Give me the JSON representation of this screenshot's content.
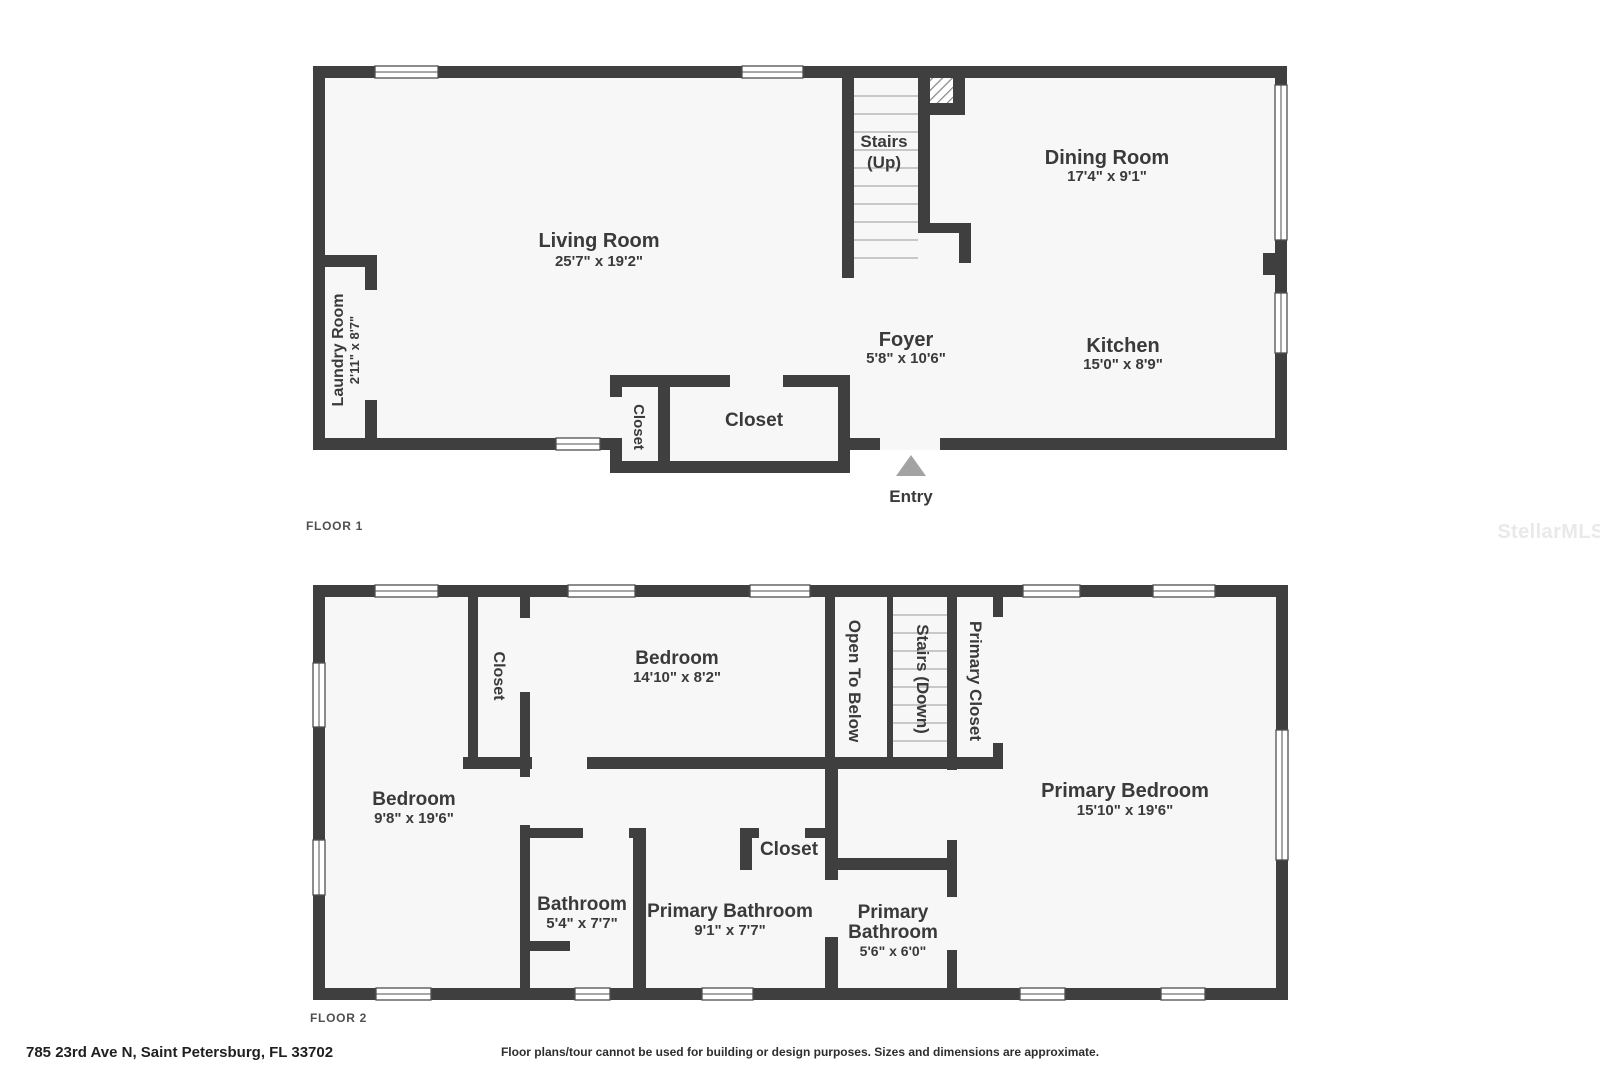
{
  "colors": {
    "wall": "#3f3f3f",
    "room_fill": "#f7f7f7",
    "tread_line": "#b8b8b8",
    "entry_arrow": "#a3a3a3",
    "label_text": "#3a3a3a",
    "watermark": "#e9e9e9"
  },
  "floor1": {
    "floor_label": "FLOOR 1",
    "rooms": {
      "living_room": {
        "name": "Living Room",
        "dims": "25'7\" x 19'2\""
      },
      "dining_room": {
        "name": "Dining Room",
        "dims": "17'4\" x 9'1\""
      },
      "kitchen": {
        "name": "Kitchen",
        "dims": "15'0\" x 8'9\""
      },
      "foyer": {
        "name": "Foyer",
        "dims": "5'8\" x 10'6\""
      },
      "laundry": {
        "name": "Laundry Room",
        "dims": "2'11\" x 8'7\""
      },
      "stairs_line1": "Stairs",
      "stairs_line2": "(Up)",
      "closet_small": "Closet",
      "closet_large": "Closet",
      "entry": "Entry"
    }
  },
  "floor2": {
    "floor_label": "FLOOR 2",
    "rooms": {
      "bedroom_left": {
        "name": "Bedroom",
        "dims": "9'8\" x 19'6\""
      },
      "closet_left": "Closet",
      "bedroom_mid": {
        "name": "Bedroom",
        "dims": "14'10\" x 8'2\""
      },
      "open_to_below": "Open To Below",
      "stairs_down": "Stairs (Down)",
      "primary_closet": "Primary Closet",
      "primary_bedroom": {
        "name": "Primary Bedroom",
        "dims": "15'10\" x 19'6\""
      },
      "bathroom": {
        "name": "Bathroom",
        "dims": "5'4\" x 7'7\""
      },
      "primary_bathroom": {
        "name": "Primary Bathroom",
        "dims": "9'1\" x 7'7\""
      },
      "primary_bathroom_2": {
        "name_line1": "Primary",
        "name_line2": "Bathroom",
        "dims": "5'6\" x 6'0\""
      },
      "closet_hall": "Closet"
    }
  },
  "footer": {
    "address": "785 23rd Ave N, Saint Petersburg, FL 33702",
    "disclaimer": "Floor plans/tour cannot be used for building or design purposes. Sizes and dimensions are approximate."
  },
  "watermark": "StellarMLS"
}
